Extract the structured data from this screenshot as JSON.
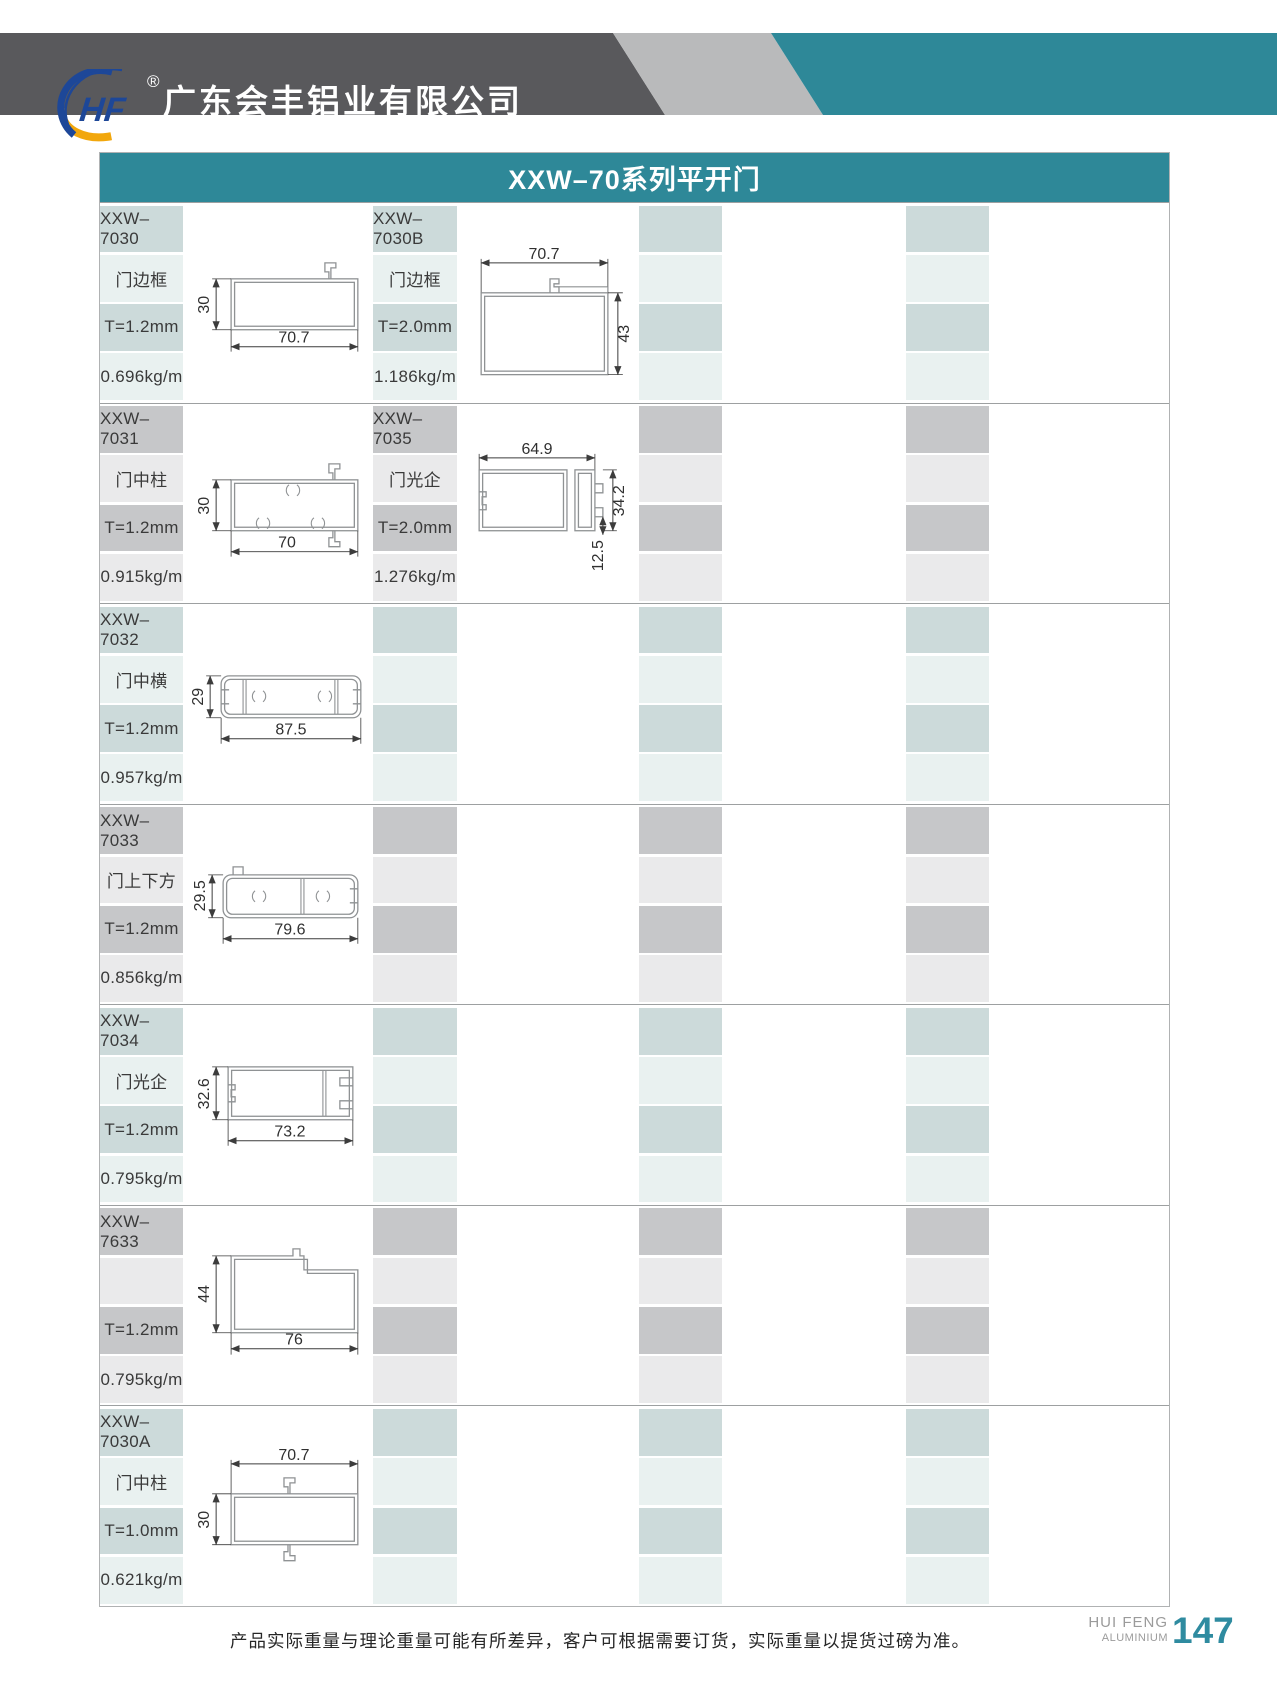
{
  "header": {
    "logo_monogram": "HF",
    "registered_mark": "®",
    "company_cn": "广东会丰铝业有限公司",
    "company_en": "GUANGDONG HUIFENG ALUMINIUM.,LTD.",
    "colors": {
      "band_dark": "#59595c",
      "band_light": "#b9babb",
      "band_teal": "#2e8898"
    }
  },
  "table": {
    "title": "XXW–70系列平开门",
    "title_bg": "#2e8898",
    "cell_colors": {
      "green_dark": "#ccdada",
      "green_light": "#e9f1f0",
      "gray_dark": "#c6c7c9",
      "gray_light": "#eaeaeb"
    }
  },
  "products": [
    {
      "code": "XXW–7030",
      "name": "门边框",
      "thickness": "T=1.2mm",
      "weight": "0.696kg/m",
      "dims": {
        "left": "30",
        "bottom": "70.7"
      }
    },
    {
      "code": "XXW–7030B",
      "name": "门边框",
      "thickness": "T=2.0mm",
      "weight": "1.186kg/m",
      "dims": {
        "top": "70.7",
        "right": "43"
      }
    },
    {
      "code": "XXW–7031",
      "name": "门中柱",
      "thickness": "T=1.2mm",
      "weight": "0.915kg/m",
      "dims": {
        "left": "30",
        "bottom": "70"
      }
    },
    {
      "code": "XXW–7035",
      "name": "门光企",
      "thickness": "T=2.0mm",
      "weight": "1.276kg/m",
      "dims": {
        "top": "64.9",
        "right": "34.2",
        "right2": "12.5"
      }
    },
    {
      "code": "XXW–7032",
      "name": "门中横",
      "thickness": "T=1.2mm",
      "weight": "0.957kg/m",
      "dims": {
        "left": "29",
        "bottom": "87.5"
      }
    },
    {
      "code": "XXW–7033",
      "name": "门上下方",
      "thickness": "T=1.2mm",
      "weight": "0.856kg/m",
      "dims": {
        "left": "29.5",
        "bottom": "79.6"
      }
    },
    {
      "code": "XXW–7034",
      "name": "门光企",
      "thickness": "T=1.2mm",
      "weight": "0.795kg/m",
      "dims": {
        "left": "32.6",
        "bottom": "73.2"
      }
    },
    {
      "code": "XXW–7633",
      "name": "",
      "thickness": "T=1.2mm",
      "weight": "0.795kg/m",
      "dims": {
        "left": "44",
        "bottom": "76"
      }
    },
    {
      "code": "XXW–7030A",
      "name": "门中柱",
      "thickness": "T=1.0mm",
      "weight": "0.621kg/m",
      "dims": {
        "top": "70.7",
        "left": "30"
      }
    }
  ],
  "footer": {
    "note": "产品实际重量与理论重量可能有所差异，客户可根据需要订货，实际重量以提货过磅为准。",
    "brand_line1": "HUI FENG",
    "brand_line2": "ALUMINIUM",
    "page_number": "147"
  }
}
